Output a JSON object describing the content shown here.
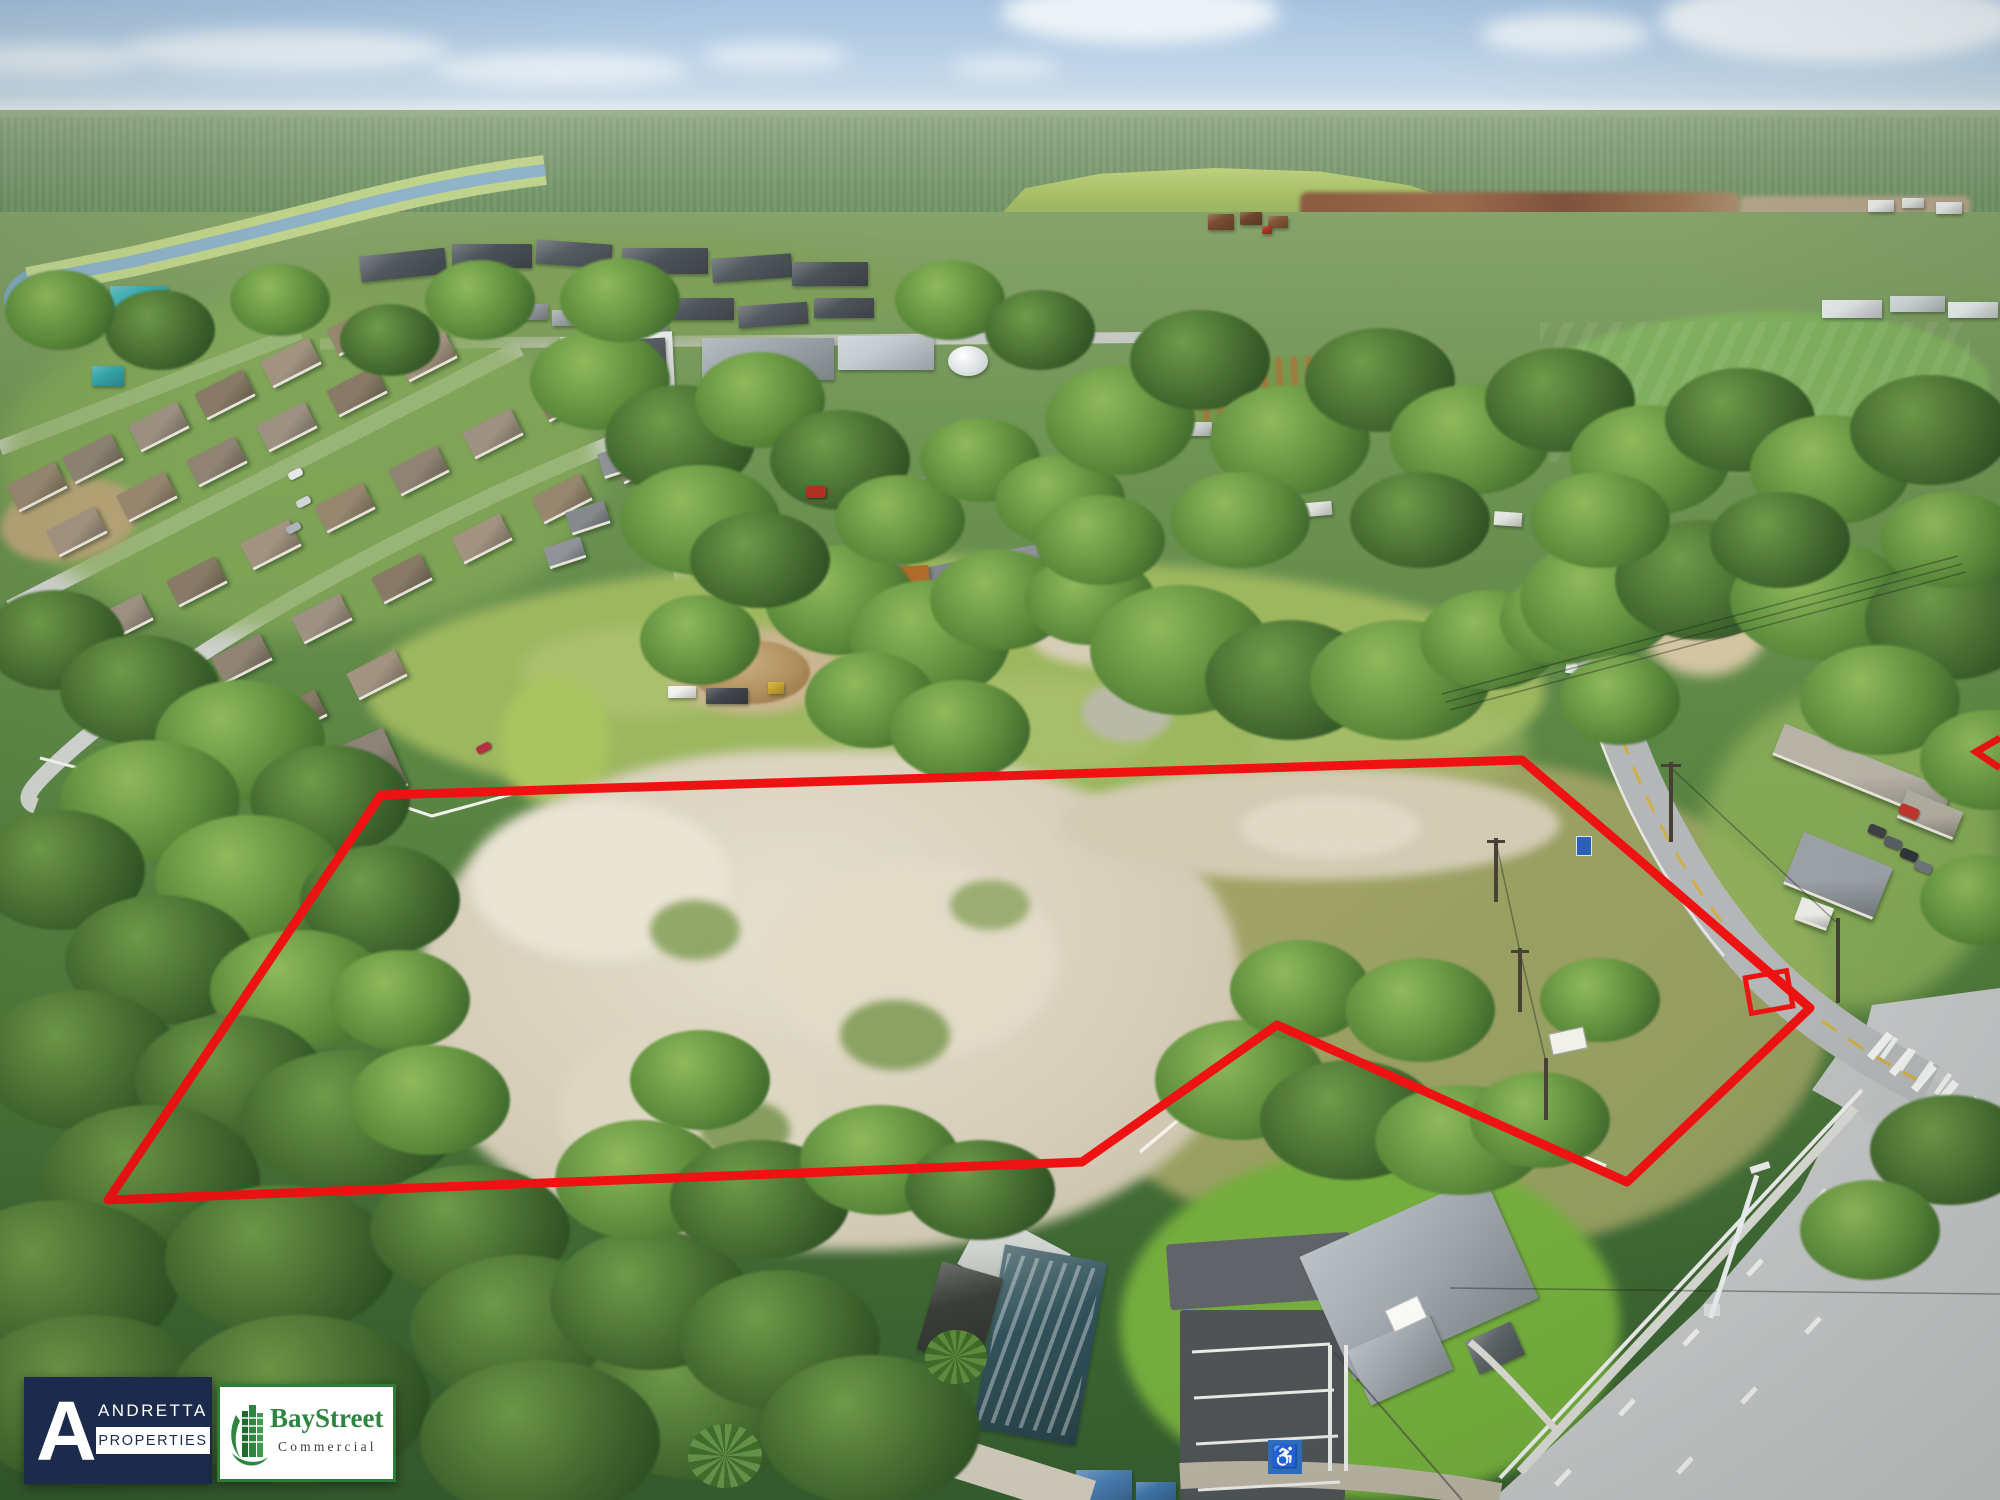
{
  "photo": {
    "kind": "aerial drone photograph",
    "subject": "vacant land parcel outlined in red, bordered by a two-lane road, highway intersection, residential subdivision and wooded areas"
  },
  "overlay": {
    "boundary_color": "#ee1212",
    "boundary_stroke_px": 9,
    "boundary_points": "381,795 1522,760 1637,858 1810,1008 1627,1182 1277,1025 1082,1162 108,1200",
    "marker_rect": {
      "x": 1748,
      "y": 974,
      "w": 42,
      "h": 36,
      "rotate_deg": -10
    },
    "edge_tick_points": "2000,738 1976,752 2000,768"
  },
  "logos": {
    "andretta": {
      "initial": "A",
      "name": "ANDRETTA",
      "division": "PROPERTIES",
      "bg": "#1c2b4c",
      "fg": "#ffffff"
    },
    "baystreet": {
      "name": "BayStreet",
      "division": "Commercial",
      "green": "#2e8540",
      "border": "#2e7d36",
      "dark_text": "#3a4046",
      "bg": "#ffffff"
    }
  },
  "palette": {
    "sky": "#b9d0e6",
    "cloud": "#f3f7fa",
    "far_forest": "#8aa37f",
    "mid_forest": "#5a8a4d",
    "pasture": "#9db75f",
    "dry_grass": "#a8a468",
    "sand": "#d8d1bd",
    "lawn": "#79b13f",
    "road_asphalt": "#b6b9ba",
    "highway": "#c4c6c7",
    "river": "#8fb3c8",
    "navy": "#1c2b4c",
    "brand_green": "#2e8540",
    "brand_border": "#2e7d36"
  }
}
